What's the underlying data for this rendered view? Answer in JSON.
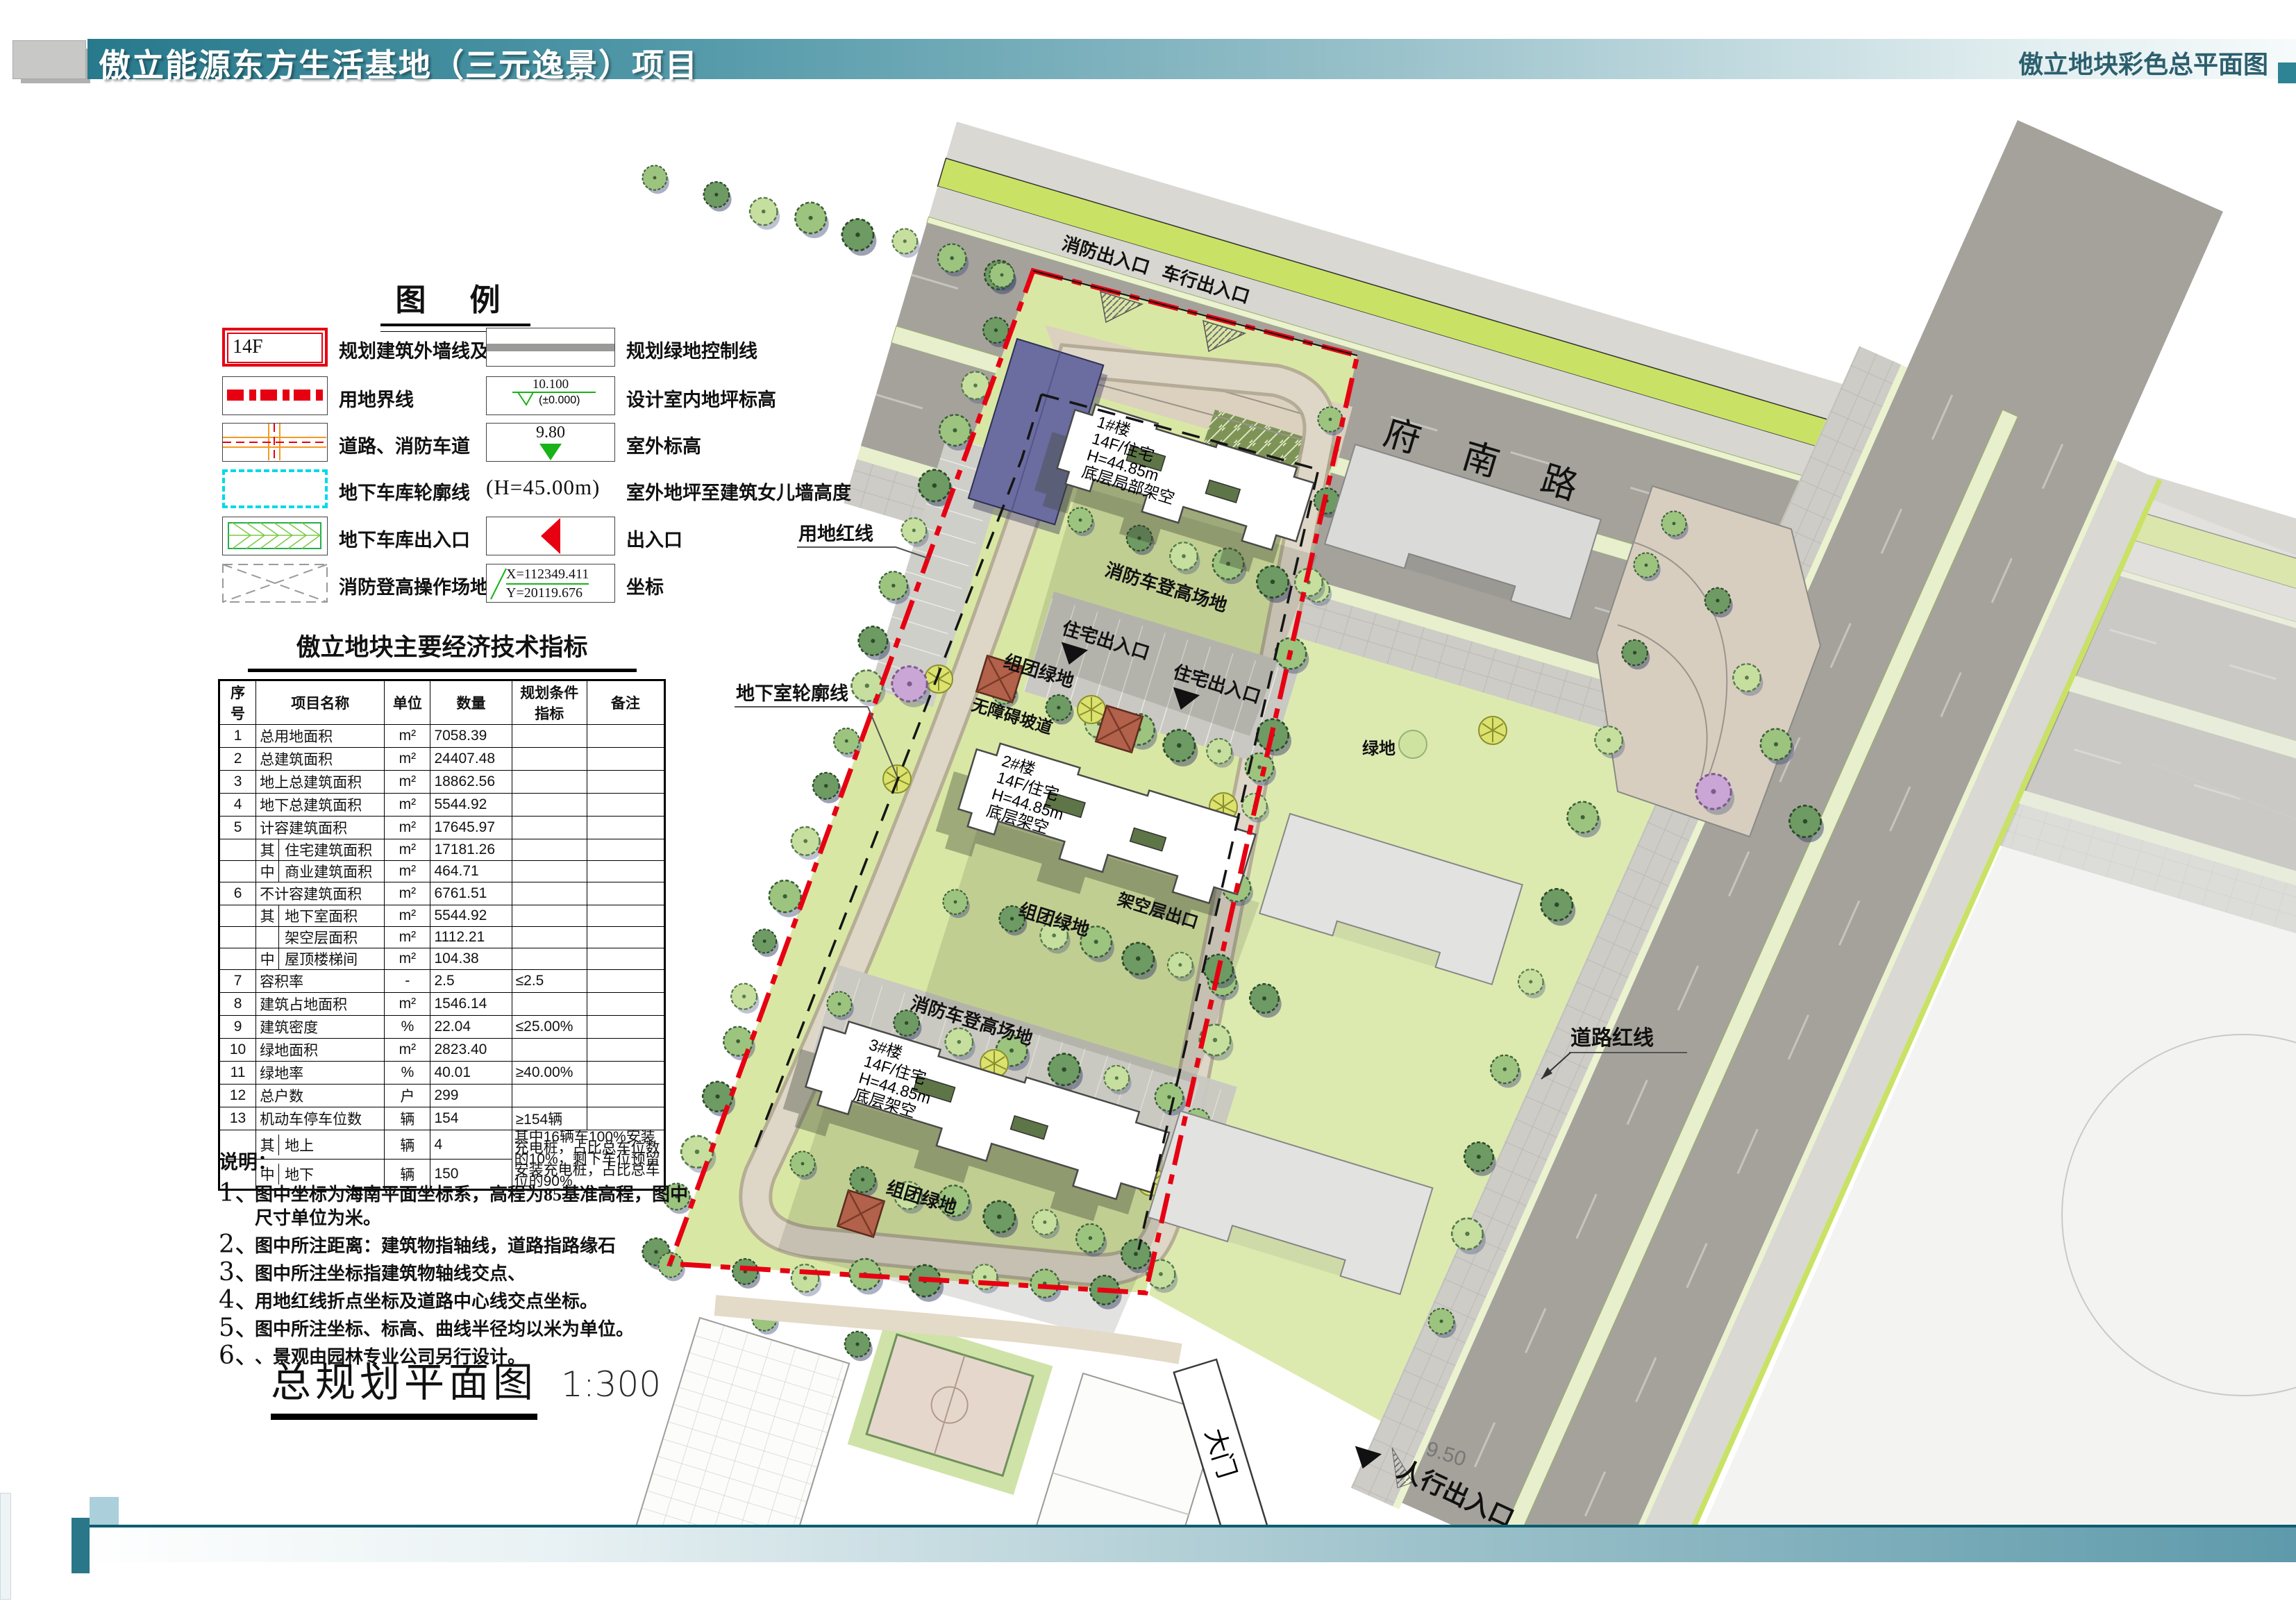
{
  "header": {
    "title_left": "傲立能源东方生活基地（三元逸景）项目",
    "title_right": "傲立地块彩色总平面图"
  },
  "colors": {
    "header_teal": "#27798c",
    "boundary_red": "#e60012",
    "garage_cyan": "#00d9e9",
    "road_gray": "#a5a29b",
    "planting_lime": "#c9e265",
    "lawn_green": "#d9e7a4"
  },
  "legend": {
    "title": "图 例",
    "left": [
      {
        "icon": "building-outline-symbol",
        "sample": "14F",
        "label": "规划建筑外墙线及层数"
      },
      {
        "icon": "site-boundary-symbol",
        "label": "用地界线"
      },
      {
        "icon": "road-symbol",
        "label": "道路、消防车道"
      },
      {
        "icon": "garage-outline-symbol",
        "label": "地下车库轮廓线"
      },
      {
        "icon": "garage-entrance-symbol",
        "label": "地下车库出入口"
      },
      {
        "icon": "fire-operation-symbol",
        "label": "消防登高操作场地"
      }
    ],
    "right": [
      {
        "icon": "green-control-line-symbol",
        "label": "规划绿地控制线"
      },
      {
        "icon": "indoor-elevation-symbol",
        "value_top": "10.100",
        "value_bottom": "(±0.000)",
        "label": "设计室内地坪标高"
      },
      {
        "icon": "outdoor-elevation-symbol",
        "value": "9.80",
        "label": "室外标高"
      },
      {
        "icon": "height-note",
        "value": "(H=45.00m)",
        "label": "室外地坪至建筑女儿墙高度"
      },
      {
        "icon": "entrance-symbol",
        "label": "出入口"
      },
      {
        "icon": "coordinate-symbol",
        "value_x": "X=112349.411",
        "value_y": "Y=20119.676",
        "label": "坐标"
      }
    ]
  },
  "table": {
    "title": "傲立地块主要经济技术指标",
    "headers": [
      "序号",
      "项目名称",
      "单位",
      "数量",
      "规划条件指标",
      "备注"
    ],
    "rows": [
      {
        "no": "1",
        "name": "总用地面积",
        "unit": "m²",
        "qty": "7058.39",
        "plan": "",
        "note": ""
      },
      {
        "no": "2",
        "name": "总建筑面积",
        "unit": "m²",
        "qty": "24407.48",
        "plan": "",
        "note": ""
      },
      {
        "no": "3",
        "name": "地上总建筑面积",
        "unit": "m²",
        "qty": "18862.56",
        "plan": "",
        "note": ""
      },
      {
        "no": "4",
        "name": "地下总建筑面积",
        "unit": "m²",
        "qty": "5544.92",
        "plan": "",
        "note": ""
      },
      {
        "no": "5",
        "name": "计容建筑面积",
        "unit": "m²",
        "qty": "17645.97",
        "plan": "",
        "note": ""
      },
      {
        "no": "",
        "sub": "其",
        "name": "住宅建筑面积",
        "unit": "m²",
        "qty": "17181.26",
        "plan": "",
        "note": ""
      },
      {
        "no": "",
        "sub": "中",
        "name": "商业建筑面积",
        "unit": "m²",
        "qty": "464.71",
        "plan": "",
        "note": ""
      },
      {
        "no": "6",
        "name": "不计容建筑面积",
        "unit": "m²",
        "qty": "6761.51",
        "plan": "",
        "note": ""
      },
      {
        "no": "",
        "sub": "其",
        "name": "地下室面积",
        "unit": "m²",
        "qty": "5544.92",
        "plan": "",
        "note": ""
      },
      {
        "no": "",
        "sub": "",
        "name": "架空层面积",
        "unit": "m²",
        "qty": "1112.21",
        "plan": "",
        "note": ""
      },
      {
        "no": "",
        "sub": "中",
        "name": "屋顶楼梯间",
        "unit": "m²",
        "qty": "104.38",
        "plan": "",
        "note": ""
      },
      {
        "no": "7",
        "name": "容积率",
        "unit": "-",
        "qty": "2.5",
        "plan": "≤2.5",
        "note": ""
      },
      {
        "no": "8",
        "name": "建筑占地面积",
        "unit": "m²",
        "qty": "1546.14",
        "plan": "",
        "note": ""
      },
      {
        "no": "9",
        "name": "建筑密度",
        "unit": "%",
        "qty": "22.04",
        "plan": "≤25.00%",
        "note": ""
      },
      {
        "no": "10",
        "name": "绿地面积",
        "unit": "m²",
        "qty": "2823.40",
        "plan": "",
        "note": ""
      },
      {
        "no": "11",
        "name": "绿地率",
        "unit": "%",
        "qty": "40.01",
        "plan": "≥40.00%",
        "note": ""
      },
      {
        "no": "12",
        "name": "总户数",
        "unit": "户",
        "qty": "299",
        "plan": "",
        "note": ""
      },
      {
        "no": "13",
        "name": "机动车停车位数",
        "unit": "辆",
        "qty": "154",
        "plan": "≥154辆",
        "note": ""
      },
      {
        "no": "",
        "sub": "其",
        "name": "地上",
        "unit": "辆",
        "qty": "4",
        "note_span": "其中16辆车100%安装充电桩，占比总车位数的10%，剩下车位预留安装充电桩，占比总车位的90%"
      },
      {
        "no": "",
        "sub": "中",
        "name": "地下",
        "unit": "辆",
        "qty": "150",
        "skip_tail": true
      }
    ]
  },
  "notes": {
    "title": "说明：",
    "items": [
      {
        "num": "1、",
        "text": "图中坐标为海南平面坐标系，高程为85基准高程，图中尺寸单位为米。"
      },
      {
        "num": "2、",
        "text": "图中所注距离：建筑物指轴线，道路指路缘石"
      },
      {
        "num": "3、",
        "text": "图中所注坐标指建筑物轴线交点、"
      },
      {
        "num": "4、",
        "text": "用地红线折点坐标及道路中心线交点坐标。"
      },
      {
        "num": "5、",
        "text": "图中所注坐标、标高、曲线半径均以米为单位。"
      },
      {
        "num": "6、",
        "text": "、景观由园林专业公司另行设计。"
      }
    ]
  },
  "scale": {
    "name": "总规划平面图",
    "ratio": "1:300"
  },
  "plan": {
    "road_name": "东府南路",
    "road_redline": "道路红线",
    "site_redline": "用地红线",
    "basement_outline": "地下室轮廓线",
    "fire_entrance": "消防出入口",
    "vehicle_entrance": "车行出入口",
    "resident_entrance": "住宅出入口",
    "fire_ladder_field": "消防车登高场地",
    "cluster_green": "组团绿地",
    "barrier_free_ramp": "无障碍坡道",
    "stilt_exit": "架空层出口",
    "gate": "大门",
    "pedestrian_entrance": "人行出入口",
    "green_space": "绿地",
    "elevation_950": "9.50",
    "buildings": [
      {
        "id": "1#楼",
        "use": "14F/住宅",
        "height": "H=44.85m",
        "note": "底层局部架空"
      },
      {
        "id": "2#楼",
        "use": "14F/住宅",
        "height": "H=44.85m",
        "note": "底层架空"
      },
      {
        "id": "3#楼",
        "use": "14F/住宅",
        "height": "H=44.85m",
        "note": "底层架空"
      }
    ]
  }
}
